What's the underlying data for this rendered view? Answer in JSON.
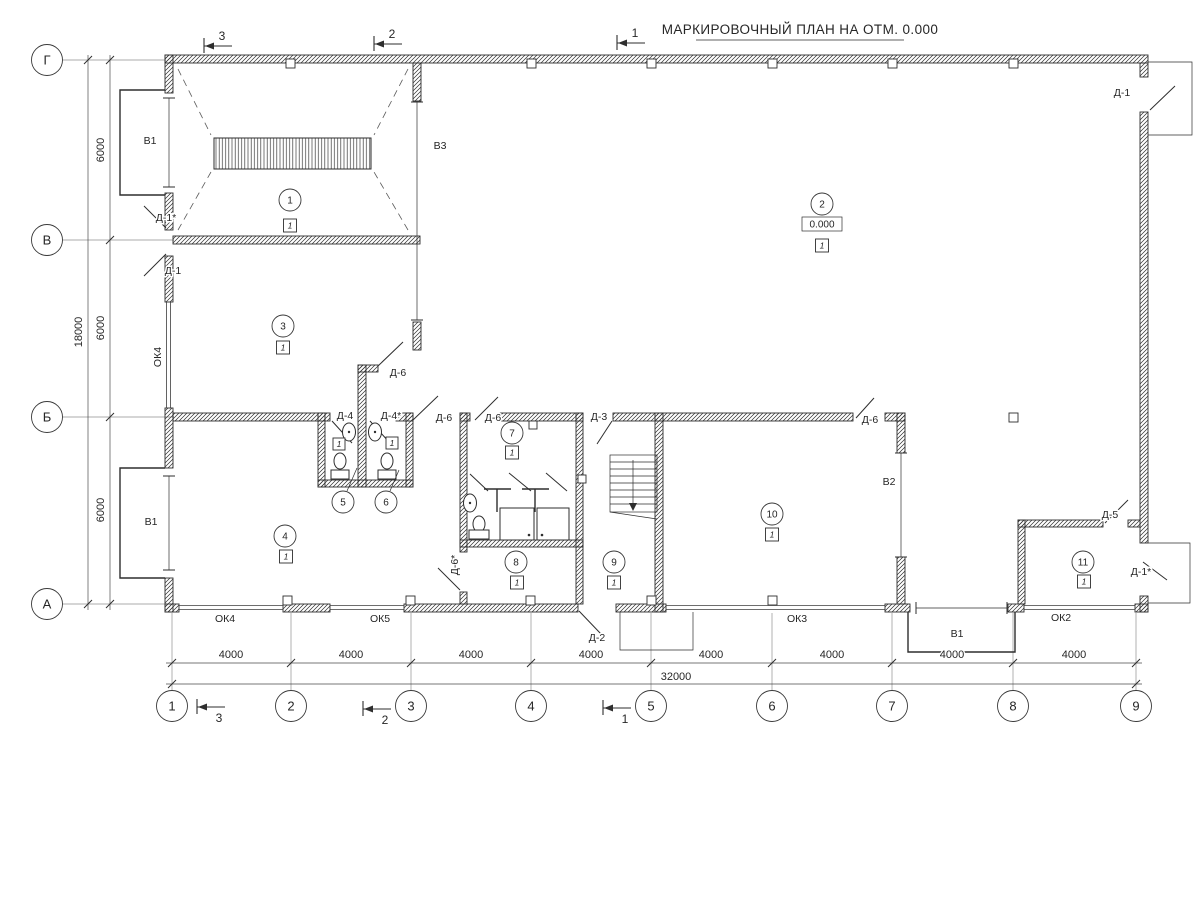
{
  "title": "МАРКИРОВОЧНЫЙ ПЛАН НА ОТМ. 0.000",
  "elevation": "0.000",
  "axes": {
    "cols": [
      "1",
      "2",
      "3",
      "4",
      "5",
      "6",
      "7",
      "8",
      "9"
    ],
    "rows": [
      "Г",
      "В",
      "Б",
      "А"
    ]
  },
  "dims": {
    "col_segments": [
      "4000",
      "4000",
      "4000",
      "4000",
      "4000",
      "4000",
      "4000",
      "4000"
    ],
    "col_total": "32000",
    "row_segments": [
      "6000",
      "6000",
      "6000"
    ],
    "row_total": "18000"
  },
  "sections": {
    "marks": [
      "3",
      "2",
      "1"
    ]
  },
  "rooms": [
    {
      "num": "1",
      "floor_type": "1"
    },
    {
      "num": "2",
      "floor_type": "1"
    },
    {
      "num": "3",
      "floor_type": "1"
    },
    {
      "num": "4",
      "floor_type": "1"
    },
    {
      "num": "5",
      "floor_type": "1"
    },
    {
      "num": "6",
      "floor_type": "1"
    },
    {
      "num": "7",
      "floor_type": "1"
    },
    {
      "num": "8",
      "floor_type": "1"
    },
    {
      "num": "9",
      "floor_type": "1"
    },
    {
      "num": "10",
      "floor_type": "1"
    },
    {
      "num": "11",
      "floor_type": "1"
    }
  ],
  "doors": {
    "d1": "Д-1",
    "d1a": "Д-1*",
    "d2": "Д-2",
    "d3": "Д-3",
    "d4": "Д-4",
    "d4a": "Д-4*",
    "d5": "Д-5",
    "d6": "Д-6",
    "d6a": "Д-6*"
  },
  "windows": {
    "v1": "В1",
    "v2": "В2",
    "v3": "В3",
    "ok2": "ОК2",
    "ok3": "ОК3",
    "ok4": "ОК4",
    "ok5": "ОК5"
  }
}
